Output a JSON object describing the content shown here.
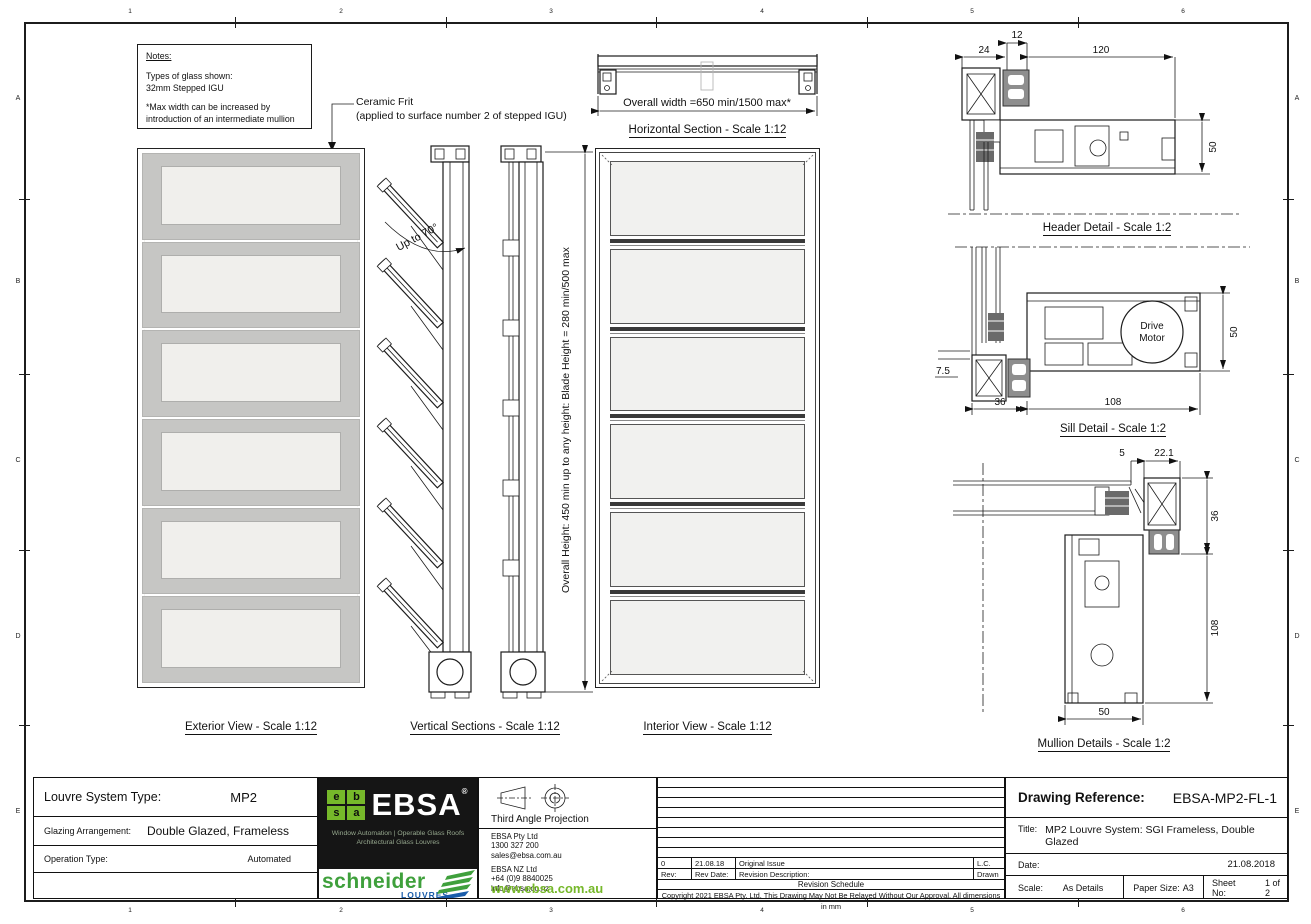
{
  "sheet": {
    "cols": [
      "1",
      "2",
      "3",
      "4",
      "5",
      "6"
    ],
    "rows": [
      "A",
      "B",
      "C",
      "D",
      "E"
    ]
  },
  "notes": {
    "title": "Notes:",
    "l1": "Types of glass shown:",
    "l2": "32mm Stepped IGU",
    "l3": "*Max width can be increased by",
    "l4": "introduction of an intermediate mullion"
  },
  "annotations": {
    "frit1": "Ceramic Frit",
    "frit2": "(applied to surface number 2 of stepped IGU)",
    "up_to": "Up to 70°",
    "overall_height": "Overall Height: 450 min up to any height: Blade Height = 280 min/500 max",
    "overall_width": "Overall  width =650 min/1500 max*",
    "motor1": "Drive",
    "motor2": "Motor"
  },
  "views": {
    "exterior": "Exterior View - Scale 1:12",
    "vertical": "Vertical Sections - Scale 1:12",
    "interior": "Interior View - Scale 1:12",
    "horizontal": "Horizontal Section - Scale 1:12",
    "header": "Header Detail - Scale 1:2",
    "sill": "Sill Detail - Scale 1:2",
    "mullion": "Mullion Details - Scale 1:2"
  },
  "dims": {
    "header": {
      "d12": "12",
      "d24": "24",
      "d120": "120",
      "d50": "50"
    },
    "sill": {
      "d75": "7.5",
      "d36": "36",
      "d108": "108",
      "d50": "50"
    },
    "mullion": {
      "d5": "5",
      "d221": "22.1",
      "d36": "36",
      "d108": "108",
      "d50": "50"
    }
  },
  "colors": {
    "ebsa_green": "#76b82a",
    "schneider_green": "#3fa03c",
    "louvres_blue": "#1a5dab",
    "blade_gray": "#c6c6c4",
    "glass_light": "#f0efec"
  },
  "titleblock": {
    "louvre_label": "Louvre System Type:",
    "louvre_value": "MP2",
    "glazing_label": "Glazing Arrangement:",
    "glazing_value": "Double Glazed, Frameless",
    "operation_label": "Operation Type:",
    "operation_value": "Automated",
    "logo": {
      "g1": "e",
      "g2": "b",
      "g3": "s",
      "g4": "a",
      "ebsa": "EBSA",
      "reg": "®",
      "tagline1": "Window Automation | Operable Glass Roofs",
      "tagline2": "Architectural Glass Louvres",
      "schneider": "schneider",
      "louvres": "LOUVRES."
    },
    "projection": "Third Angle Projection",
    "contact": {
      "au1": "EBSA Pty Ltd",
      "au2": "1300 327 200",
      "au3": "sales@ebsa.com.au",
      "nz1": "EBSA NZ Ltd",
      "nz2": "+64 (0)9 8840025",
      "nz3": "info@ebsa.co.nz",
      "web": "www.ebsa.com.au"
    },
    "revision": {
      "rev0": "0",
      "rev0_date": "21.08.18",
      "rev0_desc": "Original Issue",
      "rev0_by": "L.C.",
      "rev_label": "Rev:",
      "rev_date_label": "Rev Date:",
      "rev_desc_label": "Revision Description:",
      "drawn_label": "Drawn",
      "schedule": "Revision Schedule",
      "copyright": "Copyright 2021 EBSA Pty. Ltd.  This Drawing May Not Be Relayed Without Our Approval.  All dimensions in mm"
    },
    "reference_label": "Drawing Reference:",
    "reference_value": "EBSA-MP2-FL-1",
    "title_label": "Title:",
    "title_value": "MP2 Louvre System: SGI Frameless, Double Glazed",
    "date_label": "Date:",
    "date_value": "21.08.2018",
    "scale_label": "Scale:",
    "scale_value": "As Details",
    "paper_label": "Paper Size:",
    "paper_value": "A3",
    "sheet_label": "Sheet No:",
    "sheet_value": "1 of 2"
  }
}
